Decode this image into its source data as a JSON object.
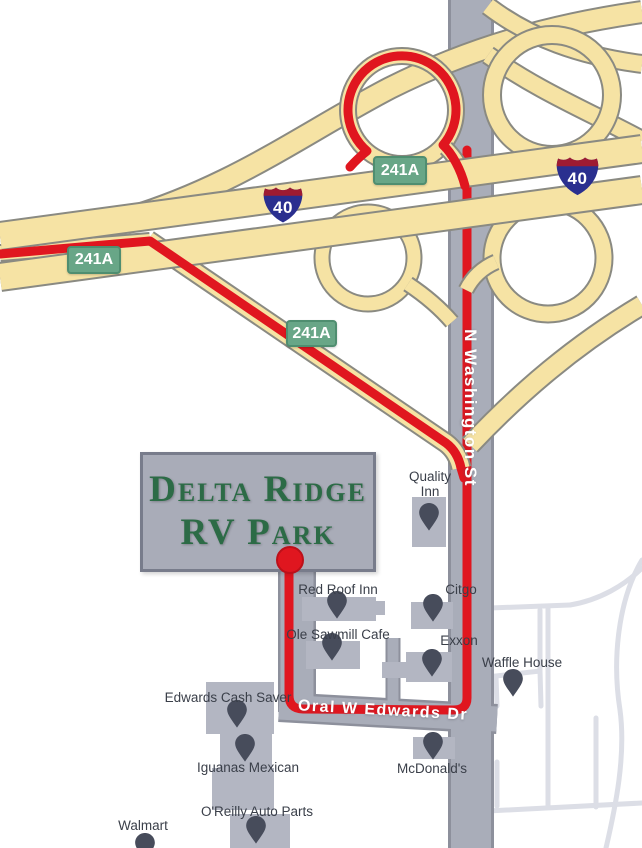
{
  "map": {
    "park": {
      "name_line1": "Delta Ridge",
      "name_line2": "RV Park"
    },
    "exit_labels": [
      "241A",
      "241A",
      "241A"
    ],
    "shield_labels": [
      "40",
      "40"
    ],
    "streets": {
      "washington": "N Washington St",
      "edwards": "Oral W Edwards Dr"
    },
    "pois": [
      {
        "name": "Quality Inn"
      },
      {
        "name": "Red Roof Inn"
      },
      {
        "name": "Citgo"
      },
      {
        "name": "Ole Sawmill Cafe"
      },
      {
        "name": "Exxon"
      },
      {
        "name": "Waffle House"
      },
      {
        "name": "Edwards Cash Saver"
      },
      {
        "name": "Iguanas Mexican"
      },
      {
        "name": "McDonald's"
      },
      {
        "name": "O'Reilly Auto Parts"
      },
      {
        "name": "Walmart"
      }
    ],
    "colors": {
      "route_red": "#E0161F",
      "highway_yellow": "#F6E3A4",
      "highway_border": "#8A8A82",
      "road_gray": "#A9ADB9",
      "road_border": "#8D909C",
      "minor_road_gray": "#DCDEE6",
      "badge_green": "#68A687",
      "shield_red": "#9E1B32",
      "shield_blue": "#2A2F8F",
      "pin_slate": "#474C5B",
      "building_gray": "#B3B6C2",
      "park_text_green": "#2C6B46"
    }
  }
}
